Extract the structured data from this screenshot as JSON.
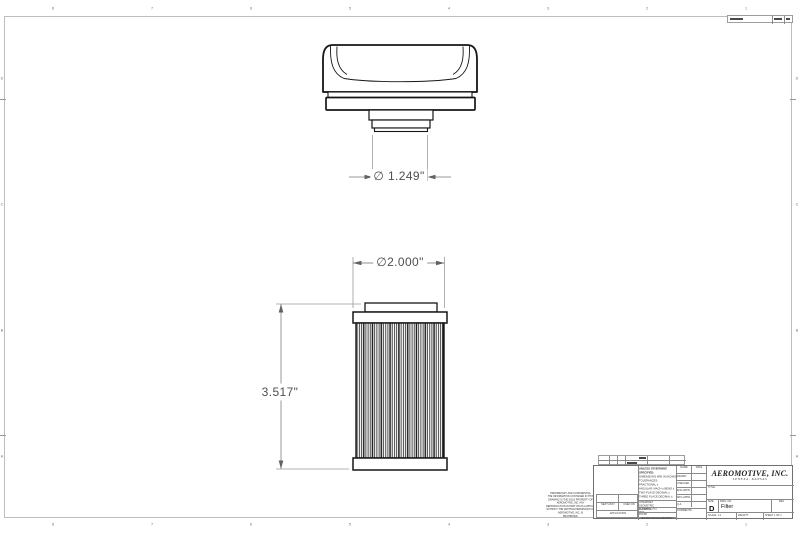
{
  "drawing": {
    "dim_cap_port_diameter": "∅ 1.249\"",
    "dim_filter_od": "∅2.000\"",
    "dim_filter_height": "3.517\""
  },
  "zones": {
    "top": [
      "8",
      "7",
      "6",
      "5",
      "4",
      "3",
      "2",
      "1"
    ],
    "bottom": [
      "8",
      "7",
      "6",
      "5",
      "4",
      "3",
      "2",
      "1"
    ],
    "left": [
      "D",
      "C",
      "B",
      "A"
    ],
    "right": [
      "D",
      "C",
      "B",
      "A"
    ]
  },
  "title_block": {
    "company_name": "AEROMOTIVE, INC.",
    "company_location": "LENEXA, KANSAS",
    "title_label": "TITLE:",
    "size_label": "SIZE",
    "size_value": "D",
    "dwg_no_label": "DWG. NO.",
    "dwg_no_value": "Filter",
    "rev_label": "REV",
    "scale_text": "SCALE: 1:1",
    "weight_label": "WEIGHT:",
    "sheet_text": "SHEET 1 OF 1",
    "name_header": "NAME",
    "date_header": "DATE",
    "approval_rows": [
      "DRAWN",
      "CHECKED",
      "ENG APPR.",
      "MFG APPR.",
      "Q.A.",
      "COMMENTS:"
    ],
    "tolerance_block": {
      "header": "UNLESS OTHERWISE SPECIFIED:",
      "lines": [
        "DIMENSIONS ARE IN INCHES",
        "TOLERANCES:",
        "FRACTIONAL ±",
        "ANGULAR: MACH ±  BEND ±",
        "TWO PLACE DECIMAL    ±",
        "THREE PLACE DECIMAL  ±"
      ]
    },
    "interpret_text": "INTERPRET GEOMETRIC\nTOLERANCING PER:",
    "material_label": "MATERIAL",
    "finish_label": "FINISH",
    "do_not_scale_text": "DO NOT SCALE DRAWING",
    "application_table": {
      "next_assy": "NEXT ASSY",
      "used_on": "USED ON",
      "application": "APPLICATION"
    },
    "proprietary_text": "PROPRIETARY AND CONFIDENTIAL\nTHE INFORMATION CONTAINED IN THIS\nDRAWING IS THE SOLE PROPERTY OF\nAEROMOTIVE, INC.  ANY\nREPRODUCTION IN PART OR AS A WHOLE\nWITHOUT THE WRITTEN PERMISSION OF\nAEROMOTIVE, INC. IS\nPROHIBITED."
  }
}
